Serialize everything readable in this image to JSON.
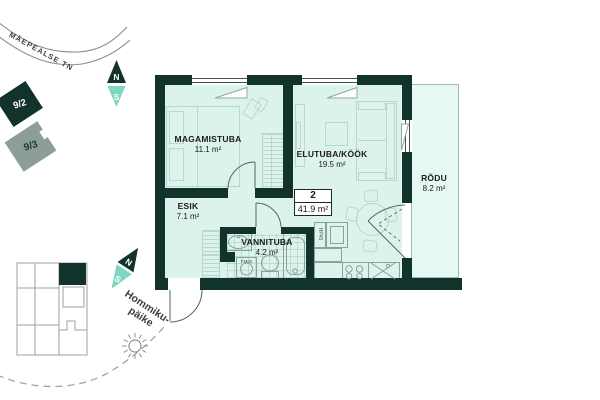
{
  "site": {
    "street": "MÄEPEALSE TN",
    "plots": [
      {
        "label": "9/2"
      },
      {
        "label": "9/3"
      }
    ],
    "compass": {
      "north": "N",
      "south": "S"
    },
    "sun": {
      "line1": "Hommiku-",
      "line2": "päike"
    }
  },
  "apartment": {
    "number": "2",
    "total_area": "41.9 m²"
  },
  "rooms": {
    "bedroom": {
      "name": "MAGAMISTUBA",
      "area": "11.1 m²"
    },
    "living": {
      "name": "ELUTUBA/KÖÖK",
      "area": "19.5 m²"
    },
    "hall": {
      "name": "ESIK",
      "area": "7.1 m²"
    },
    "bath": {
      "name": "VANNITUBA",
      "area": "4.2 m²"
    },
    "balcony": {
      "name": "RÕDU",
      "area": "8.2 m²"
    }
  },
  "labels": {
    "washer": "PM65",
    "duct": "HP45"
  },
  "colors": {
    "wall": "#12332b",
    "room_fill": "#dcf3ec",
    "balcony_fill": "#e6f8f2",
    "accent_teal": "#7fd6c2",
    "plot_gray": "#8d9e99",
    "furniture_line": "#b7d8cf"
  }
}
